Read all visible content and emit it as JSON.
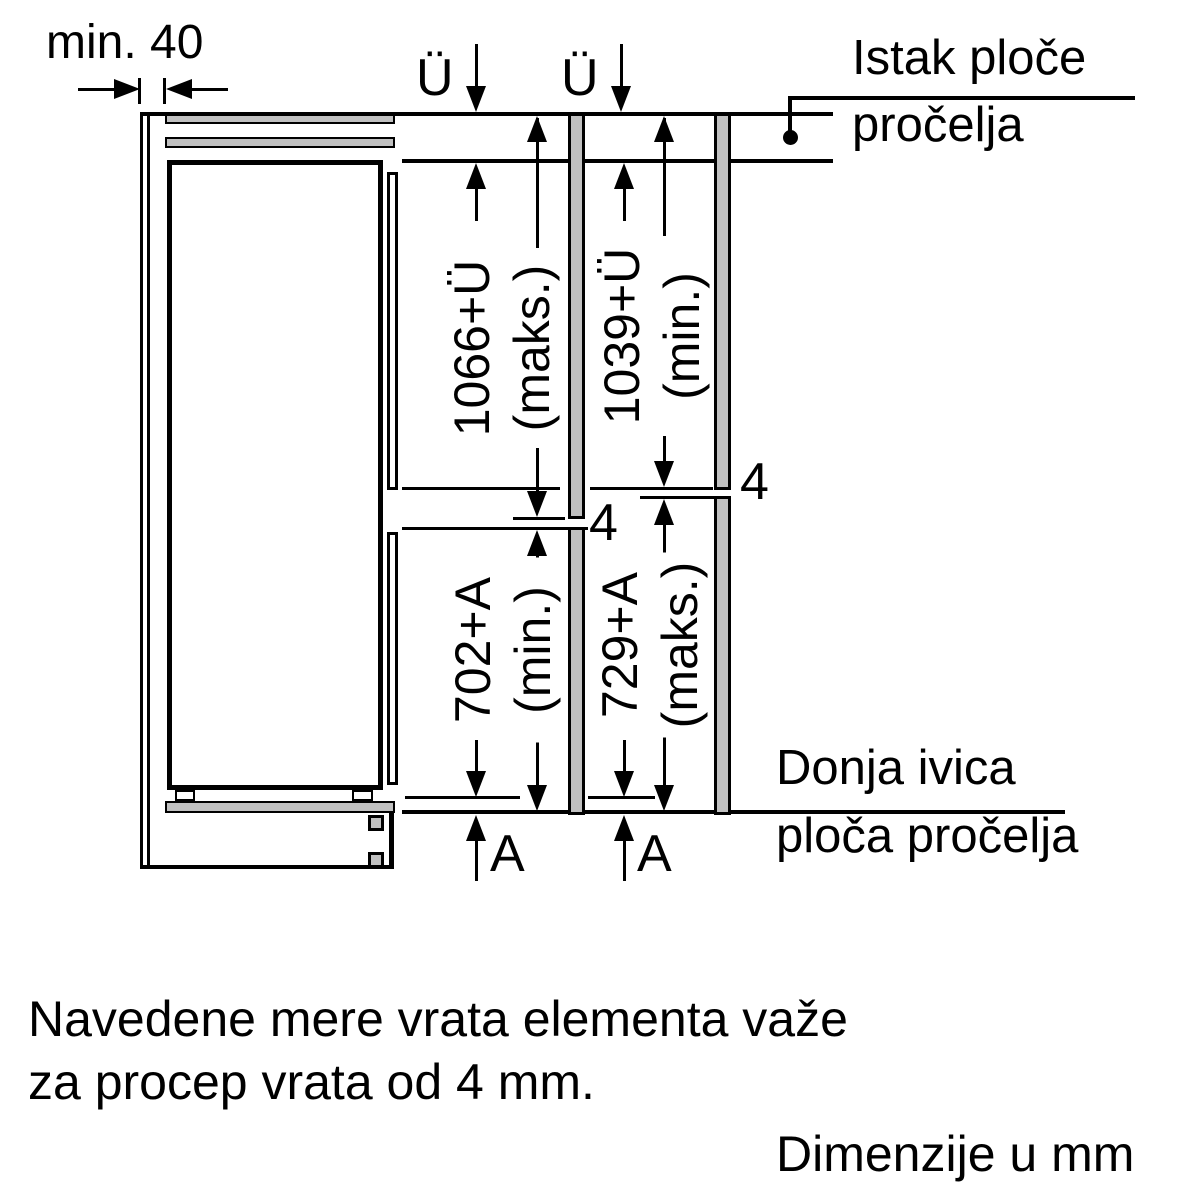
{
  "colors": {
    "line": "#000000",
    "panel_fill": "#c0c0c0",
    "background": "#ffffff"
  },
  "top": {
    "min_gap_label": "min. 40",
    "overhang_left": "Ü",
    "overhang_right": "Ü",
    "callout_line1": "Istak ploče",
    "callout_line2": "pročelja"
  },
  "dims": {
    "left_upper": {
      "value": "1066+Ü",
      "qualifier": "(maks.)"
    },
    "right_upper": {
      "value": "1039+Ü",
      "qualifier": "(min.)"
    },
    "left_lower": {
      "value": "702+A",
      "qualifier": "(min.)"
    },
    "right_lower": {
      "value": "729+A",
      "qualifier": "(maks.)"
    },
    "gap_left": "4",
    "gap_right": "4",
    "offset_left": "A",
    "offset_right": "A"
  },
  "bottom_callout": {
    "line1": "Donja ivica",
    "line2": "ploča pročelja"
  },
  "notes": {
    "line1": "Navedene mere vrata elementa važe",
    "line2": "za procep vrata od 4 mm.",
    "units": "Dimenzije u mm"
  }
}
